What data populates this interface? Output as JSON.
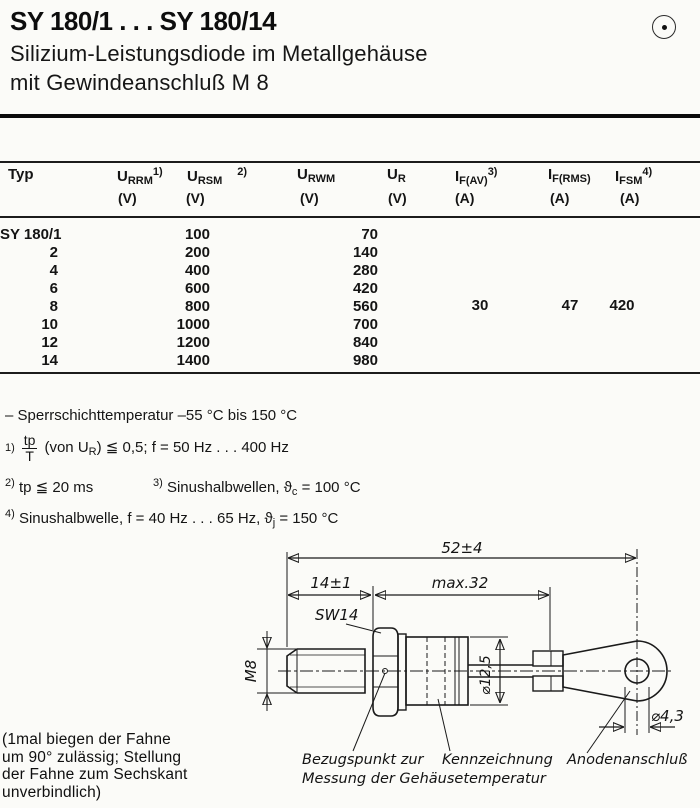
{
  "header": {
    "title": "SY 180/1 . . . SY 180/14",
    "subtitle_line1": "Silizium-Leistungsdiode im Metallgehäuse",
    "subtitle_line2": "mit Gewindeanschluß M 8",
    "corner_icon": "circled-dot"
  },
  "table": {
    "columns": [
      {
        "label": "Typ"
      },
      {
        "sym": "U",
        "sub": "RRM",
        "sup": "1)",
        "unit": "(V)"
      },
      {
        "sym": "U",
        "sub": "RSM",
        "sup": "2)",
        "unit": "(V)"
      },
      {
        "sym": "U",
        "sub": "RWM",
        "sup": "",
        "unit": "(V)"
      },
      {
        "sym": "U",
        "sub": "R",
        "sup": "",
        "unit": "(V)"
      },
      {
        "sym": "I",
        "sub": "F(AV)",
        "sup": "3)",
        "unit": "(A)"
      },
      {
        "sym": "I",
        "sub": "F(RMS)",
        "sup": "",
        "unit": "(A)"
      },
      {
        "sym": "I",
        "sub": "FSM",
        "sup": "4)",
        "unit": "(A)"
      }
    ],
    "rows": [
      {
        "typ": "SY 180/1",
        "u1": "100",
        "u2": "70"
      },
      {
        "typ": "2",
        "u1": "200",
        "u2": "140"
      },
      {
        "typ": "4",
        "u1": "400",
        "u2": "280"
      },
      {
        "typ": "6",
        "u1": "600",
        "u2": "420"
      },
      {
        "typ": "8",
        "u1": "800",
        "u2": "560"
      },
      {
        "typ": "10",
        "u1": "1000",
        "u2": "700"
      },
      {
        "typ": "12",
        "u1": "1200",
        "u2": "840"
      },
      {
        "typ": "14",
        "u1": "1400",
        "u2": "980"
      }
    ],
    "shared": {
      "if_av": "30",
      "if_rms": "47",
      "ifsm": "420"
    }
  },
  "notes": {
    "temp": "– Sperrschichttemperatur  –55 °C bis 150 °C",
    "fn1": {
      "marker": "1)",
      "num": "tp",
      "den": "T",
      "a": "(von U",
      "a_sub": "R",
      "b": ")  ≦  0,5;  f = 50 Hz . . . 400 Hz"
    },
    "fn2": {
      "marker": "2)",
      "text": "tp ≦ 20 ms"
    },
    "fn3": {
      "marker": "3)",
      "a": "Sinushalbwellen,  ϑ",
      "a_sub": "c",
      "b": " = 100 °C"
    },
    "fn4": {
      "marker": "4)",
      "a": "Sinushalbwelle,  f = 40 Hz . . . 65 Hz,  ϑ",
      "a_sub": "j",
      "b": "  = 150 °C"
    }
  },
  "drawing": {
    "dim_total": "52±4",
    "dim_thread": "14±1",
    "dim_body": "max.32",
    "wrench": "SW14",
    "thread_label": "M8",
    "dim_diameter": "⌀12,5",
    "dim_hole": "⌀4,3",
    "callout_reference": "Bezugspunkt zur\nMessung der Gehäusetemperatur",
    "callout_marking": "Kennzeichnung",
    "callout_anode": "Anodenanschluß"
  },
  "note_left": "(1mal biegen der Fahne\num 90° zulässig; Stellung\nder Fahne zum Sechskant\nunverbindlich)"
}
